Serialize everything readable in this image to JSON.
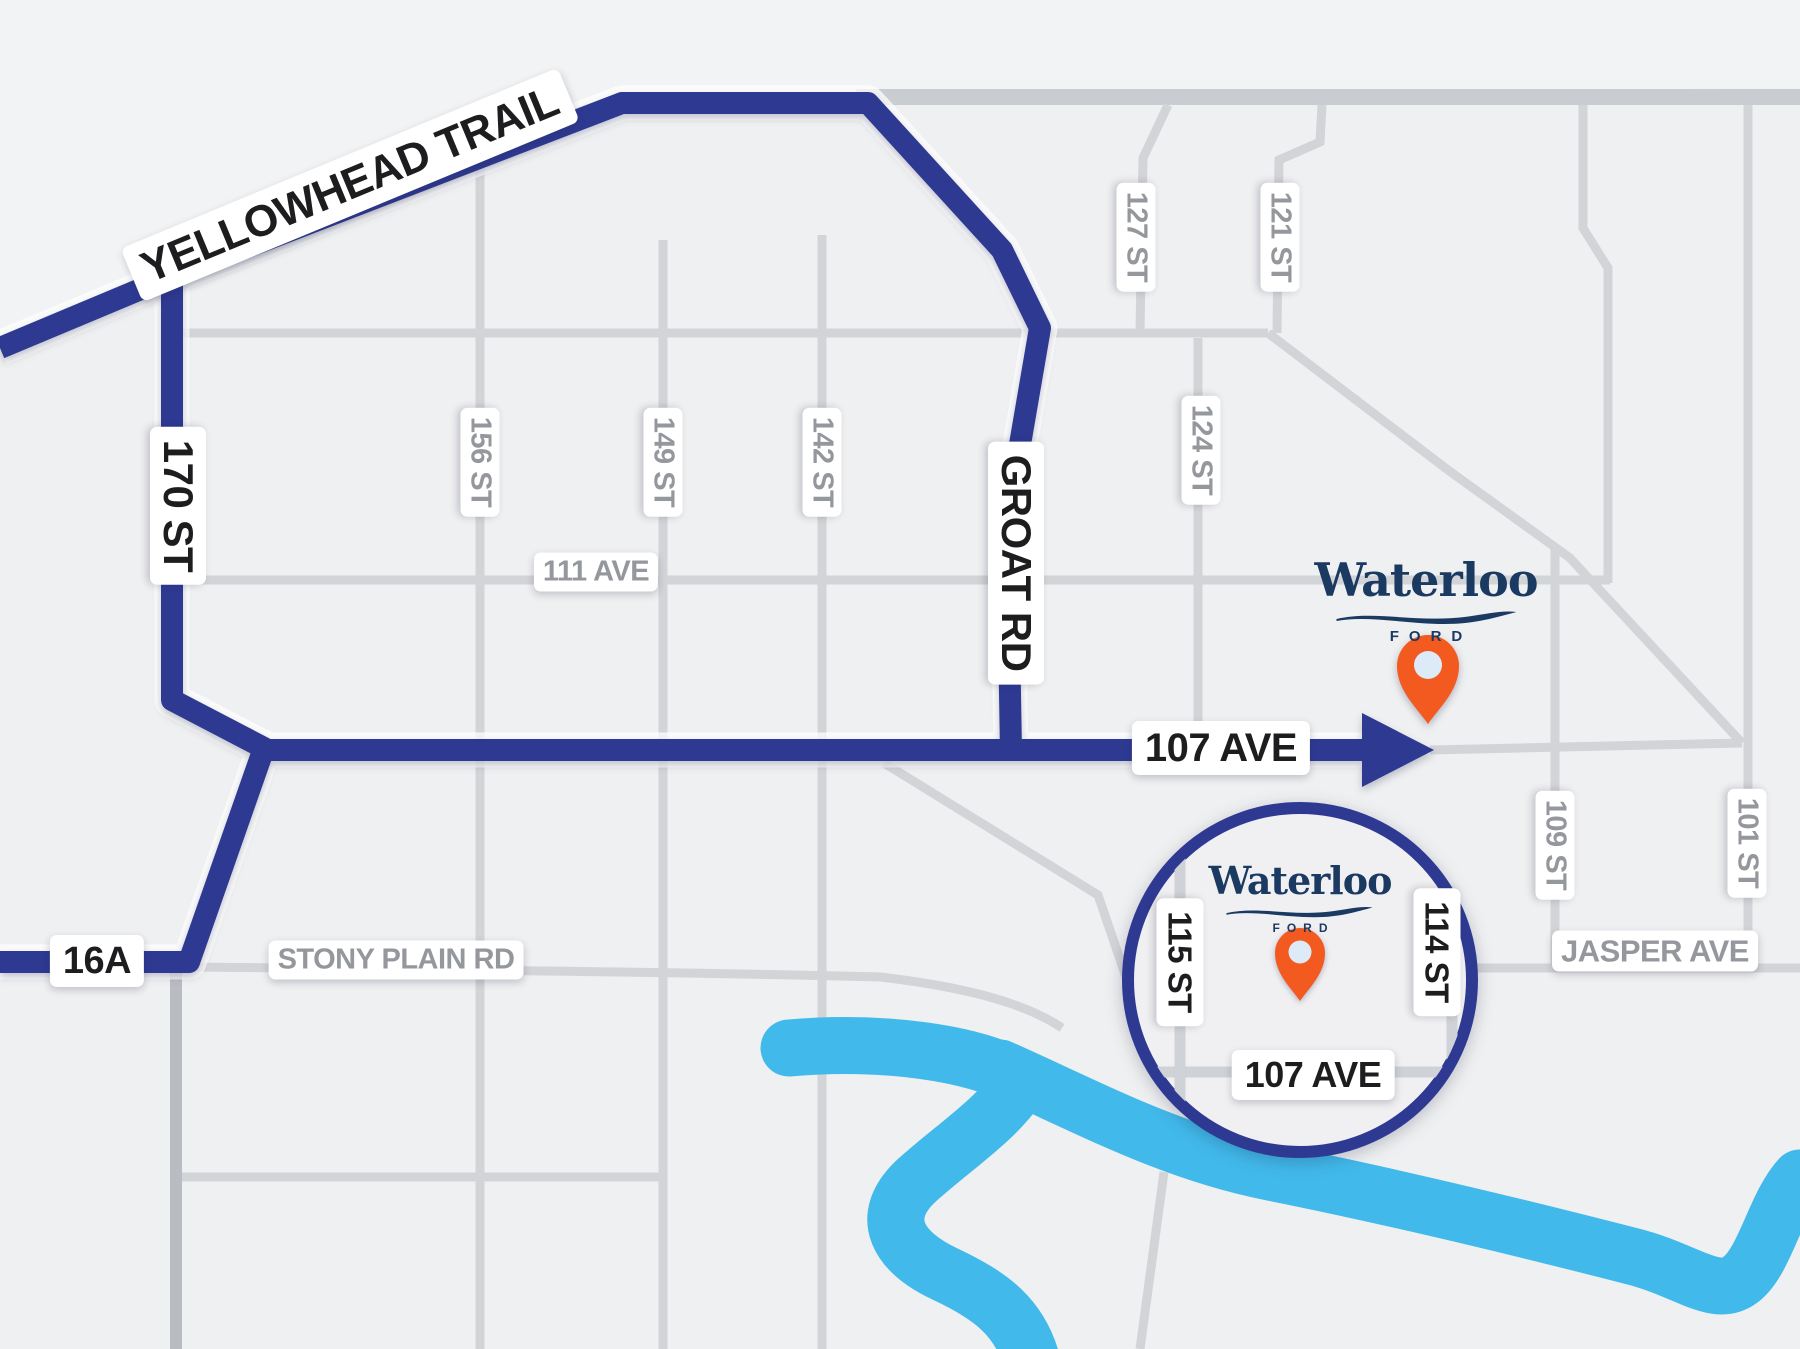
{
  "map": {
    "route_labels": {
      "yellowhead": "YELLOWHEAD TRAIL",
      "st170": "170 ST",
      "groat_rd": "GROAT RD",
      "ave107": "107 AVE",
      "hwy16a": "16A"
    },
    "street_labels": {
      "st156": "156 ST",
      "st149": "149 ST",
      "st142": "142 ST",
      "st127": "127 ST",
      "st121": "121 ST",
      "st124": "124 ST",
      "ave111": "111 AVE",
      "stony_plain": "STONY PLAIN RD",
      "jasper": "JASPER AVE",
      "st109": "109 ST",
      "st101": "101 ST"
    },
    "inset": {
      "st115": "115 ST",
      "st114": "114 ST",
      "ave107": "107 AVE"
    },
    "brand": {
      "name": "Waterloo",
      "division": "FORD"
    },
    "colors": {
      "background": "#eff0f1",
      "road_gray": "#d2d4d8",
      "road_gray_dark": "#c9ccd1",
      "route_blue": "#2e3a92",
      "river_blue": "#41b9ea",
      "pin_orange": "#f25a20",
      "pin_inner": "#ddebf8",
      "logo_navy": "#1b3a62",
      "label_black": "#1d1d1f",
      "label_gray": "#94979c"
    }
  }
}
